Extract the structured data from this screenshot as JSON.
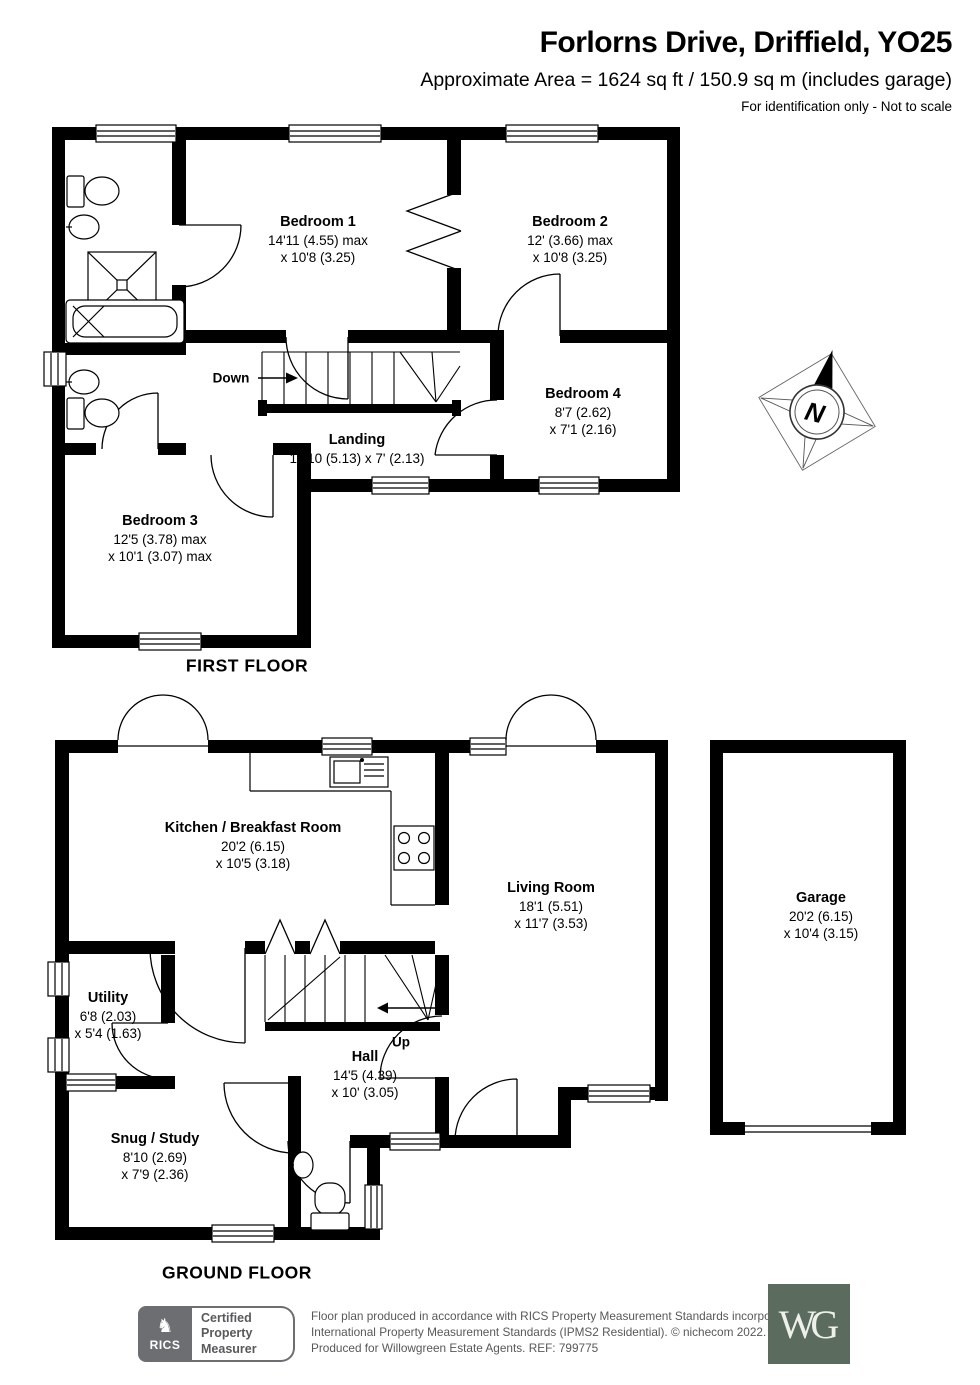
{
  "header": {
    "title": "Forlorns Drive, Driffield, YO25",
    "area_line": "Approximate Area = 1624 sq ft / 150.9 sq m (includes garage)",
    "disclaimer": "For identification only - Not to scale"
  },
  "floors": {
    "first": {
      "title": "FIRST FLOOR",
      "stairs_label": "Down",
      "rooms": {
        "bedroom1": {
          "name": "Bedroom 1",
          "line1": "14'11 (4.55) max",
          "line2": "x 10'8 (3.25)"
        },
        "bedroom2": {
          "name": "Bedroom 2",
          "line1": "12' (3.66) max",
          "line2": "x 10'8 (3.25)"
        },
        "bedroom4": {
          "name": "Bedroom 4",
          "line1": "8'7 (2.62)",
          "line2": "x 7'1 (2.16)"
        },
        "landing": {
          "name": "Landing",
          "line1": "16'10 (5.13) x 7' (2.13)"
        },
        "bedroom3": {
          "name": "Bedroom 3",
          "line1": "12'5 (3.78) max",
          "line2": "x 10'1 (3.07) max"
        }
      }
    },
    "ground": {
      "title": "GROUND FLOOR",
      "stairs_label": "Up",
      "rooms": {
        "kitchen": {
          "name": "Kitchen / Breakfast Room",
          "line1": "20'2 (6.15)",
          "line2": "x 10'5 (3.18)"
        },
        "living": {
          "name": "Living Room",
          "line1": "18'1 (5.51)",
          "line2": "x 11'7 (3.53)"
        },
        "garage": {
          "name": "Garage",
          "line1": "20'2 (6.15)",
          "line2": "x 10'4 (3.15)"
        },
        "utility": {
          "name": "Utility",
          "line1": "6'8 (2.03)",
          "line2": "x 5'4 (1.63)"
        },
        "hall": {
          "name": "Hall",
          "line1": "14'5 (4.39)",
          "line2": "x 10' (3.05)"
        },
        "snug": {
          "name": "Snug / Study",
          "line1": "8'10 (2.69)",
          "line2": "x 7'9 (2.36)"
        }
      }
    }
  },
  "compass": {
    "north_label": "N"
  },
  "footer": {
    "rics_label": "RICS",
    "badge": {
      "line1": "Certified",
      "line2": "Property",
      "line3": "Measurer"
    },
    "disclaimer_line1": "Floor plan produced in accordance with RICS Property Measurement Standards incorporating",
    "disclaimer_line2": "International Property Measurement Standards (IPMS2 Residential). © nichecom 2022.",
    "disclaimer_line3": "Produced for Willowgreen Estate Agents. REF: 799775",
    "logo_text": "WG"
  },
  "colors": {
    "wall": "#000000",
    "footer_text": "#58595b",
    "badge_grey": "#6d6e71",
    "logo_green": "#5b6b5e"
  }
}
